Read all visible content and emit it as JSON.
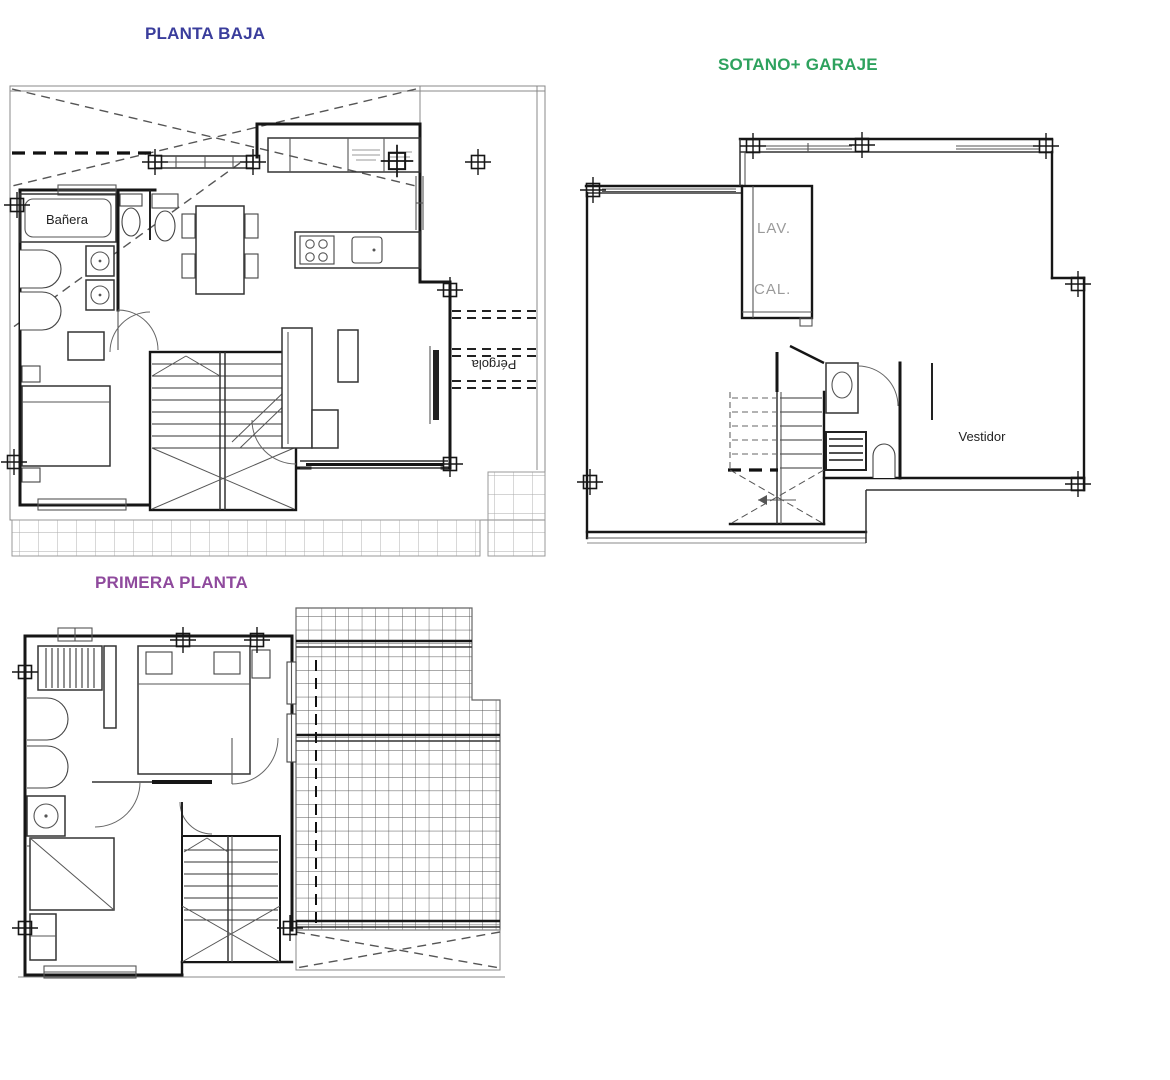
{
  "titles": {
    "ground_floor": {
      "text": "PLANTA BAJA",
      "color": "#3A3D9C"
    },
    "basement": {
      "text": "SOTANO+ GARAJE",
      "color": "#2EA25E"
    },
    "first_floor": {
      "text": "PRIMERA PLANTA",
      "color": "#8F4A9D"
    }
  },
  "room_labels": {
    "banera": "Bañera",
    "pergola": "Pérgola",
    "lav": "LAV.",
    "cal": "CAL.",
    "vestidor": "Vestidor"
  },
  "drawing_colors": {
    "walls": "#161616",
    "thin_lines": "#888888",
    "gray_labels": "#9A9A9A"
  }
}
